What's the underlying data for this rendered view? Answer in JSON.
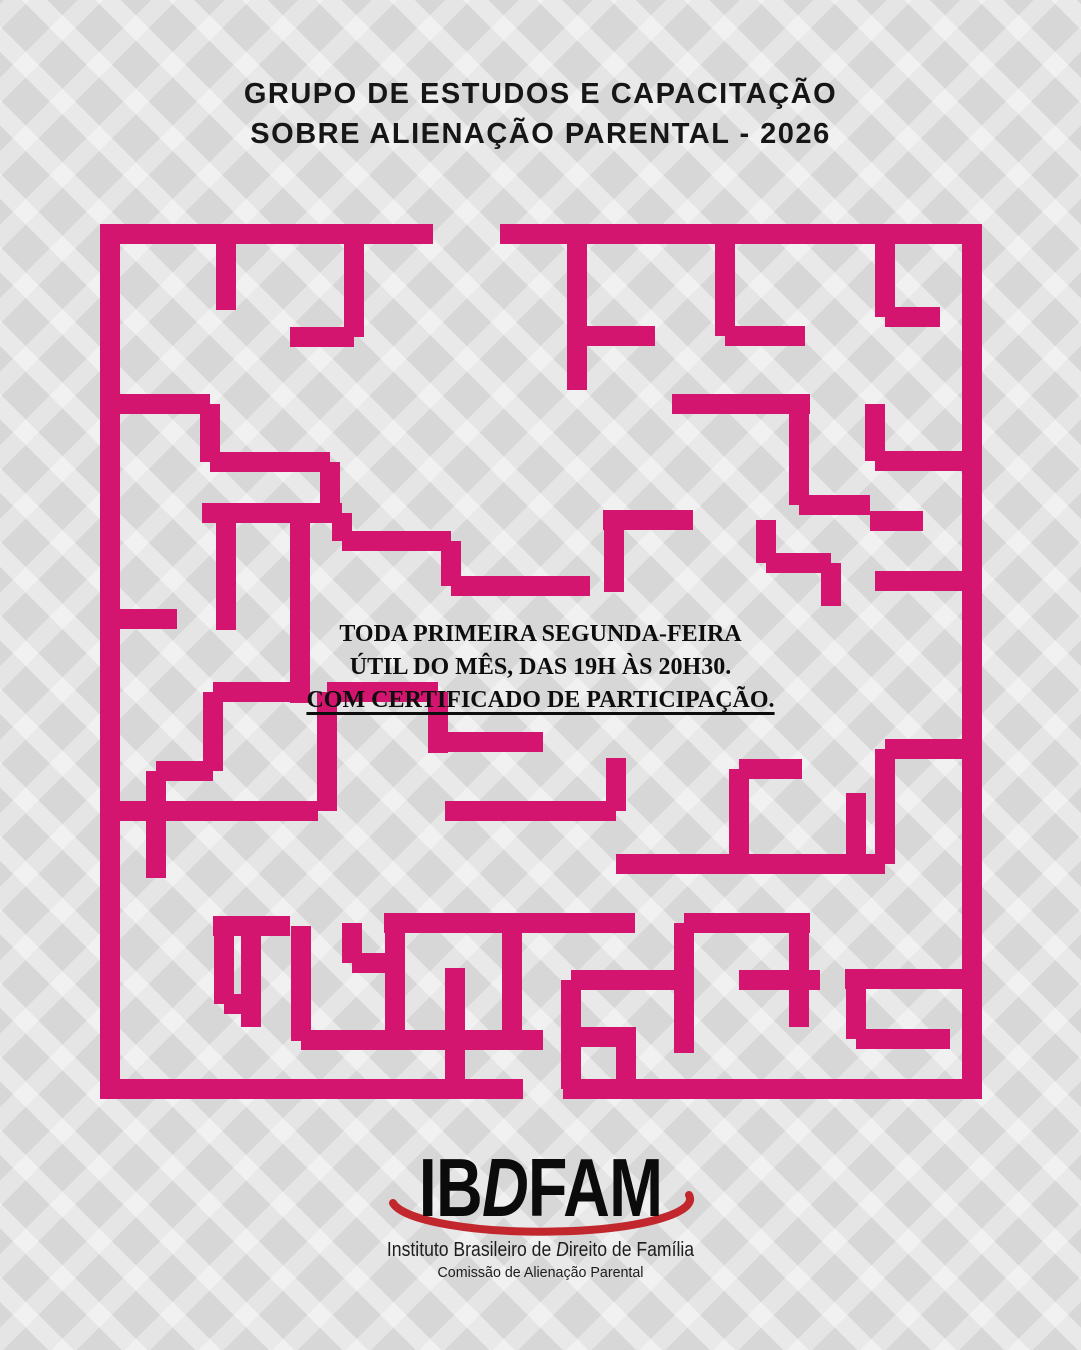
{
  "title": {
    "line1": "GRUPO DE ESTUDOS E CAPACITAÇÃO",
    "line2": "SOBRE ALIENAÇÃO PARENTAL - 2026"
  },
  "info": {
    "line1": "TODA PRIMEIRA SEGUNDA-FEIRA",
    "line2": "ÚTIL DO MÊS, DAS 19H ÀS 20H30.",
    "line3": "COM CERTIFICADO DE PARTICIPAÇÃO."
  },
  "logo": {
    "acronym": {
      "pre": "IB",
      "italic": "D",
      "post": "FAM"
    },
    "institute": {
      "pre": "Instituto Brasileiro de ",
      "italic": "D",
      "post": "ireito de Família"
    },
    "committee": "Comissão de Alienação Parental",
    "swoosh_color": "#C1272D"
  },
  "colors": {
    "background": "#D8D7D7",
    "title_text": "#161616",
    "maze_pink": "#D4156F"
  },
  "maze": {
    "color": "#D4156F",
    "thickness": 20,
    "segments": [
      [
        100,
        234,
        433,
        234
      ],
      [
        500,
        234,
        972,
        234
      ],
      [
        110,
        224,
        110,
        1099
      ],
      [
        972,
        224,
        972,
        1099
      ],
      [
        100,
        1089,
        523,
        1089
      ],
      [
        563,
        1089,
        972,
        1089
      ],
      [
        226,
        234,
        226,
        310
      ],
      [
        354,
        234,
        354,
        337
      ],
      [
        290,
        337,
        354,
        337
      ],
      [
        110,
        404,
        210,
        404
      ],
      [
        210,
        404,
        210,
        462
      ],
      [
        210,
        462,
        330,
        462
      ],
      [
        330,
        462,
        330,
        513
      ],
      [
        202,
        513,
        342,
        513
      ],
      [
        342,
        513,
        342,
        541
      ],
      [
        342,
        541,
        451,
        541
      ],
      [
        226,
        513,
        226,
        630
      ],
      [
        300,
        513,
        300,
        703
      ],
      [
        110,
        619,
        177,
        619
      ],
      [
        451,
        541,
        451,
        586
      ],
      [
        451,
        586,
        590,
        586
      ],
      [
        577,
        234,
        577,
        390
      ],
      [
        577,
        336,
        655,
        336
      ],
      [
        725,
        234,
        725,
        336
      ],
      [
        725,
        336,
        805,
        336
      ],
      [
        672,
        404,
        810,
        404
      ],
      [
        799,
        404,
        799,
        505
      ],
      [
        799,
        505,
        870,
        505
      ],
      [
        885,
        234,
        885,
        317
      ],
      [
        885,
        317,
        940,
        317
      ],
      [
        875,
        404,
        875,
        461
      ],
      [
        875,
        461,
        972,
        461
      ],
      [
        870,
        521,
        923,
        521
      ],
      [
        875,
        581,
        972,
        581
      ],
      [
        603,
        520,
        693,
        520
      ],
      [
        614,
        520,
        614,
        592
      ],
      [
        766,
        520,
        766,
        563
      ],
      [
        766,
        563,
        831,
        563
      ],
      [
        831,
        563,
        831,
        606
      ],
      [
        213,
        692,
        300,
        692
      ],
      [
        213,
        692,
        213,
        771
      ],
      [
        156,
        771,
        213,
        771
      ],
      [
        156,
        771,
        156,
        878
      ],
      [
        110,
        811,
        318,
        811
      ],
      [
        445,
        811,
        616,
        811
      ],
      [
        327,
        692,
        438,
        692
      ],
      [
        327,
        692,
        327,
        811
      ],
      [
        438,
        692,
        438,
        753
      ],
      [
        438,
        742,
        543,
        742
      ],
      [
        616,
        758,
        616,
        811
      ],
      [
        739,
        769,
        802,
        769
      ],
      [
        739,
        769,
        739,
        864
      ],
      [
        856,
        793,
        856,
        864
      ],
      [
        616,
        864,
        885,
        864
      ],
      [
        885,
        749,
        885,
        864
      ],
      [
        885,
        749,
        972,
        749
      ],
      [
        213,
        926,
        290,
        926
      ],
      [
        224,
        926,
        224,
        1004
      ],
      [
        224,
        1004,
        251,
        1004
      ],
      [
        251,
        926,
        251,
        1027
      ],
      [
        301,
        926,
        301,
        1041
      ],
      [
        301,
        1040,
        543,
        1040
      ],
      [
        352,
        923,
        352,
        963
      ],
      [
        352,
        963,
        395,
        963
      ],
      [
        395,
        923,
        395,
        1050
      ],
      [
        384,
        923,
        635,
        923
      ],
      [
        512,
        923,
        512,
        1048
      ],
      [
        455,
        968,
        455,
        1089
      ],
      [
        571,
        980,
        571,
        1089
      ],
      [
        571,
        980,
        684,
        980
      ],
      [
        684,
        923,
        684,
        1053
      ],
      [
        684,
        923,
        810,
        923
      ],
      [
        799,
        923,
        799,
        1027
      ],
      [
        739,
        980,
        820,
        980
      ],
      [
        626,
        1027,
        626,
        1089
      ],
      [
        571,
        1037,
        626,
        1037
      ],
      [
        845,
        979,
        972,
        979
      ],
      [
        856,
        979,
        856,
        1039
      ],
      [
        856,
        1039,
        950,
        1039
      ]
    ]
  }
}
